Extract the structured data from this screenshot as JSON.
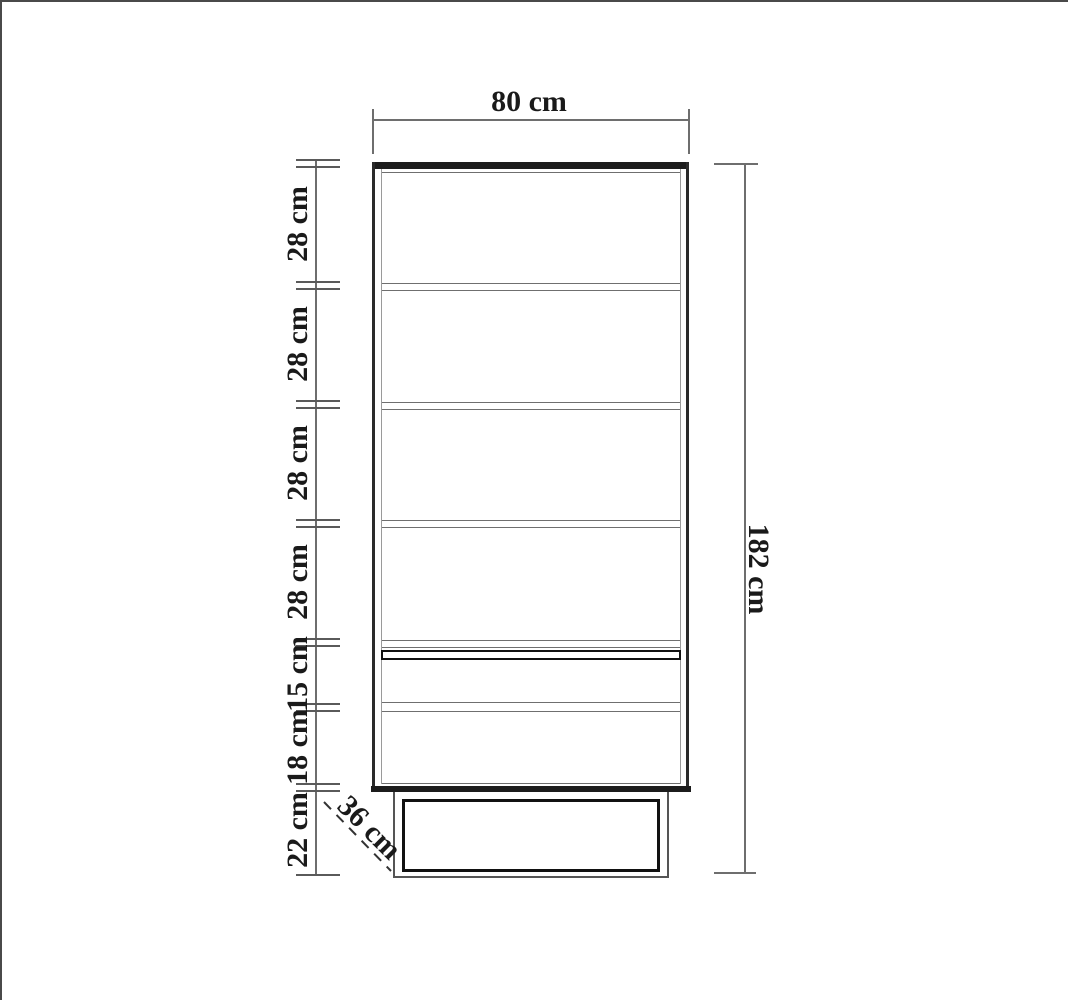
{
  "drawing": {
    "type": "furniture-dimension-diagram",
    "unit": "cm",
    "width_dimension": {
      "label": "80 cm",
      "value_cm": 80
    },
    "height_dimension": {
      "label": "182 cm",
      "value_cm": 182
    },
    "depth_dimension": {
      "label": "36 cm",
      "value_cm": 36
    },
    "left_dimensions": [
      {
        "label": "28 cm",
        "value_cm": 28
      },
      {
        "label": "28 cm",
        "value_cm": 28
      },
      {
        "label": "28 cm",
        "value_cm": 28
      },
      {
        "label": "28 cm",
        "value_cm": 28
      },
      {
        "label": "15 cm",
        "value_cm": 15
      },
      {
        "label": "18 cm",
        "value_cm": 18
      },
      {
        "label": "22 cm",
        "value_cm": 22
      }
    ]
  }
}
